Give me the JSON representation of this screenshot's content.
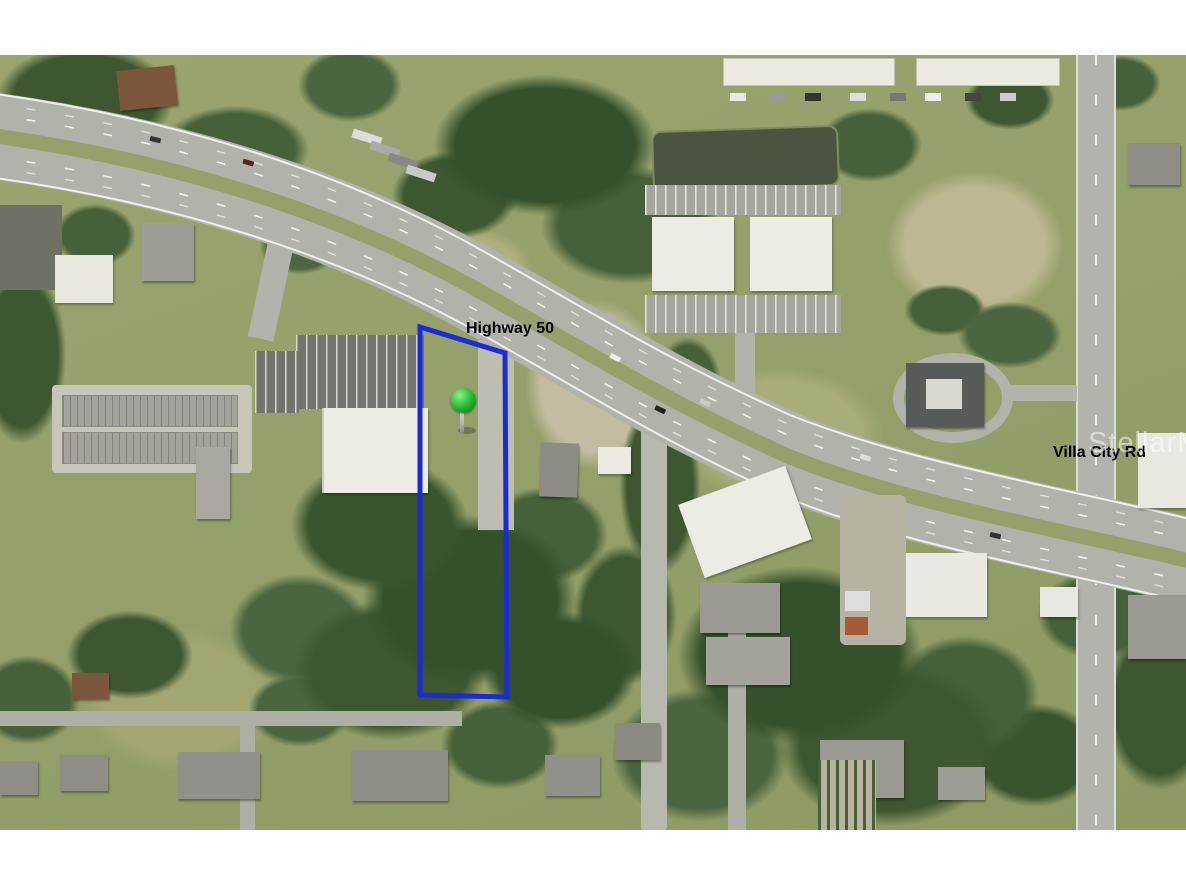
{
  "map": {
    "labels": {
      "highway": "Highway 50",
      "cross_street": "Villa City Rd"
    },
    "watermark": "StellarMLS",
    "parcel": {
      "points": "420,272 505,298 507,642 420,640"
    }
  },
  "colors": {
    "parcel": "#1c2cd2",
    "pin": "#1eb52c",
    "label": "#000000",
    "watermark": "#ffffff",
    "letterbox": "#ffffff"
  }
}
